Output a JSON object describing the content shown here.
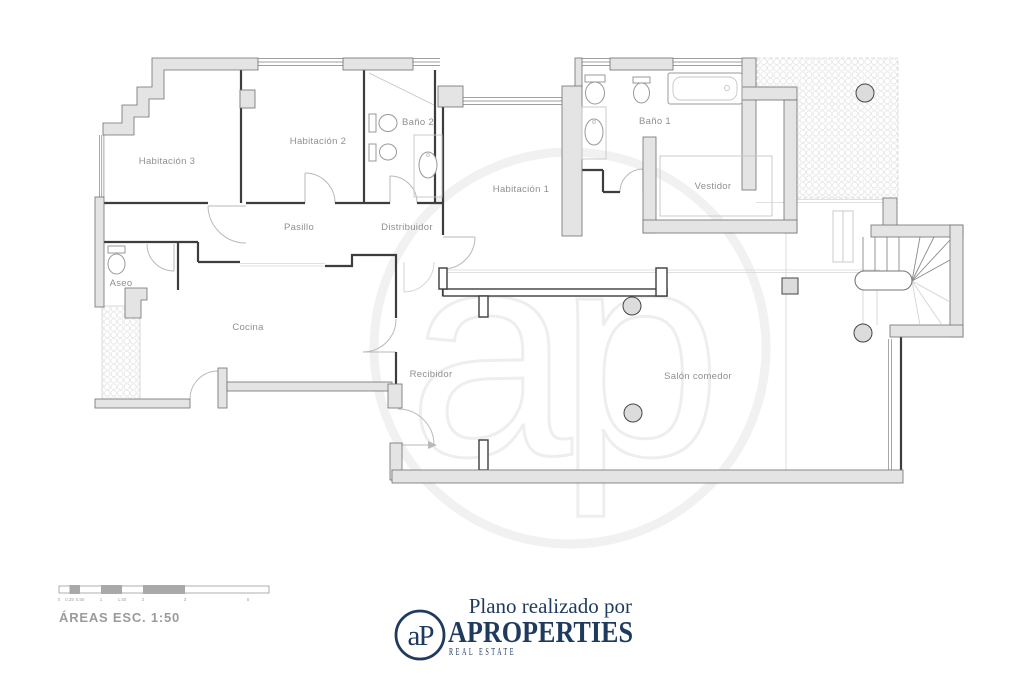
{
  "plan": {
    "rooms": [
      {
        "id": "habitacion-3",
        "label": "Habitación 3"
      },
      {
        "id": "habitacion-2",
        "label": "Habitación 2"
      },
      {
        "id": "bano-2",
        "label": "Baño 2"
      },
      {
        "id": "habitacion-1",
        "label": "Habitación 1"
      },
      {
        "id": "bano-1",
        "label": "Baño 1"
      },
      {
        "id": "vestidor",
        "label": "Vestidor"
      },
      {
        "id": "pasillo",
        "label": "Pasillo"
      },
      {
        "id": "distribuidor",
        "label": "Distribuidor"
      },
      {
        "id": "aseo",
        "label": "Aseo"
      },
      {
        "id": "cocina",
        "label": "Cocina"
      },
      {
        "id": "recibidor",
        "label": "Recibidor"
      },
      {
        "id": "salon",
        "label": "Salón comedor"
      }
    ],
    "watermark_text": "ap"
  },
  "scalebar": {
    "title": "ÁREAS ESC. 1:50",
    "ticks": [
      "0",
      "0.25",
      "0.50",
      "1",
      "1.50",
      "2",
      "3",
      "5"
    ]
  },
  "footer": {
    "tagline": "Plano realizado por",
    "brand": "APROPERTIES",
    "subbrand": "REAL ESTATE",
    "monogram": "aP"
  },
  "colors": {
    "brand_navy": "#1e3a5e",
    "wall_fill": "#e4e4e4",
    "label_gray": "#8f8f8f"
  }
}
